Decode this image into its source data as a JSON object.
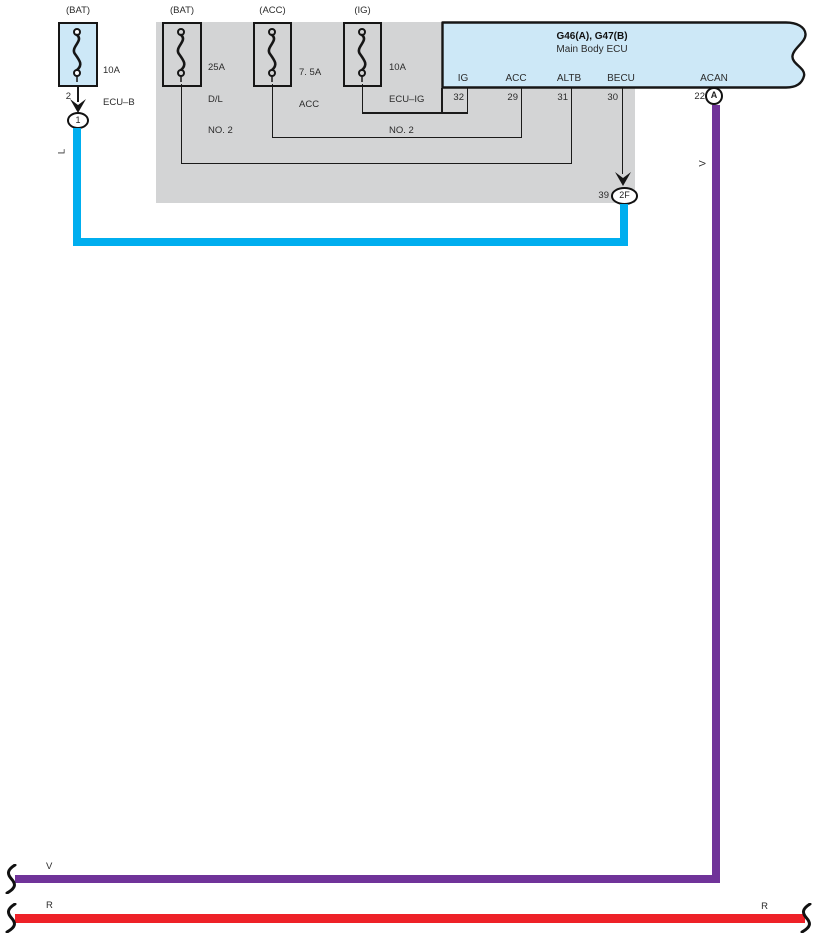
{
  "ecu": {
    "title": "G46(A), G47(B)",
    "subtitle": "Main Body ECU",
    "pins": [
      {
        "label": "IG",
        "number": "32"
      },
      {
        "label": "ACC",
        "number": "29"
      },
      {
        "label": "ALTB",
        "number": "31"
      },
      {
        "label": "BECU",
        "number": "30"
      },
      {
        "label": "ACAN",
        "number": "22",
        "connector": "A"
      }
    ]
  },
  "fuses": [
    {
      "source": "(BAT)",
      "line1": "10A",
      "line2": "ECU–B",
      "line3": ""
    },
    {
      "source": "(BAT)",
      "line1": "25A",
      "line2": "D/L",
      "line3": "NO. 2"
    },
    {
      "source": "(ACC)",
      "line1": "7. 5A",
      "line2": "ACC",
      "line3": ""
    },
    {
      "source": "(IG)",
      "line1": "10A",
      "line2": "ECU–IG",
      "line3": "NO. 2"
    }
  ],
  "connectors": {
    "c1": {
      "pin": "2",
      "label": "1"
    },
    "c2f": {
      "pin": "39",
      "label": "2F"
    }
  },
  "wires": {
    "blue": {
      "code": "L",
      "hex": "#00AEEF"
    },
    "violet": {
      "code": "V",
      "hex": "#703399"
    },
    "red": {
      "code": "R",
      "hex": "#EE2128"
    }
  },
  "palette": {
    "light_blue": "#CDE8F7",
    "gray": "#D3D4D5",
    "line": "#1a1a1a"
  }
}
